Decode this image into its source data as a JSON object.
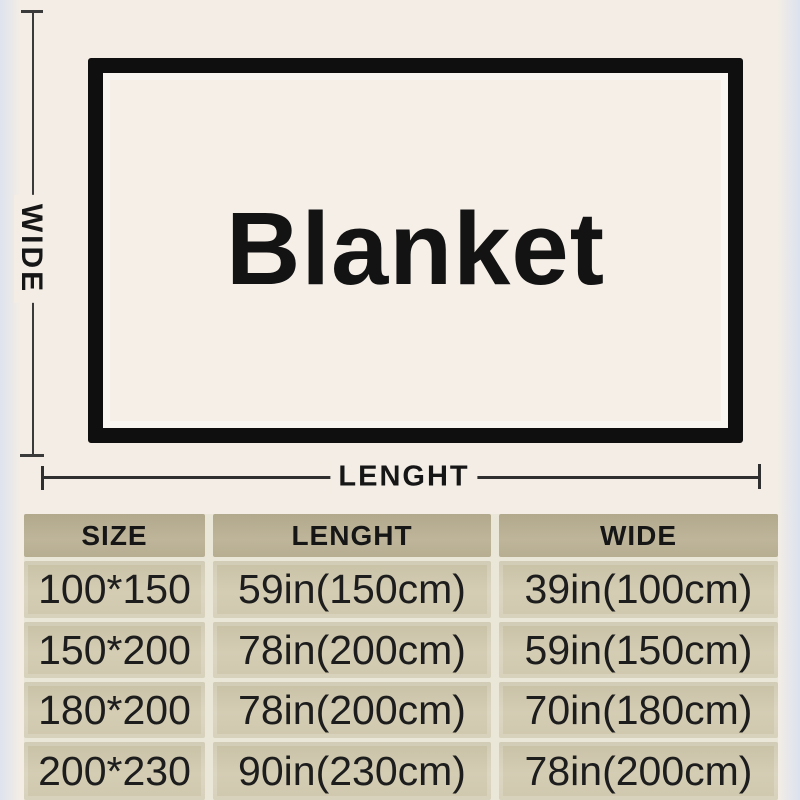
{
  "diagram": {
    "blanket_label": "Blanket",
    "wide_axis_label": "WIDE",
    "length_axis_label": "LENGHT"
  },
  "table": {
    "headers": {
      "size": "SIZE",
      "length": "LENGHT",
      "wide": "WIDE"
    },
    "rows": [
      {
        "size": "100*150",
        "length": "59in(150cm)",
        "wide": "39in(100cm)"
      },
      {
        "size": "150*200",
        "length": "78in(200cm)",
        "wide": "59in(150cm)"
      },
      {
        "size": "180*200",
        "length": "78in(200cm)",
        "wide": "70in(180cm)"
      },
      {
        "size": "200*230",
        "length": "90in(230cm)",
        "wide": "78in(200cm)"
      }
    ]
  },
  "colors": {
    "background": "#f3ede5",
    "dimension_line": "#3a3a3a",
    "rect_border": "#0f0f0f",
    "rect_fill": "#f5efe8",
    "table_header_bg": "#b8af93",
    "table_cell_bg": "#d0c9b0",
    "table_gap": "#ebe7d8",
    "text": "#1a1a1a"
  }
}
